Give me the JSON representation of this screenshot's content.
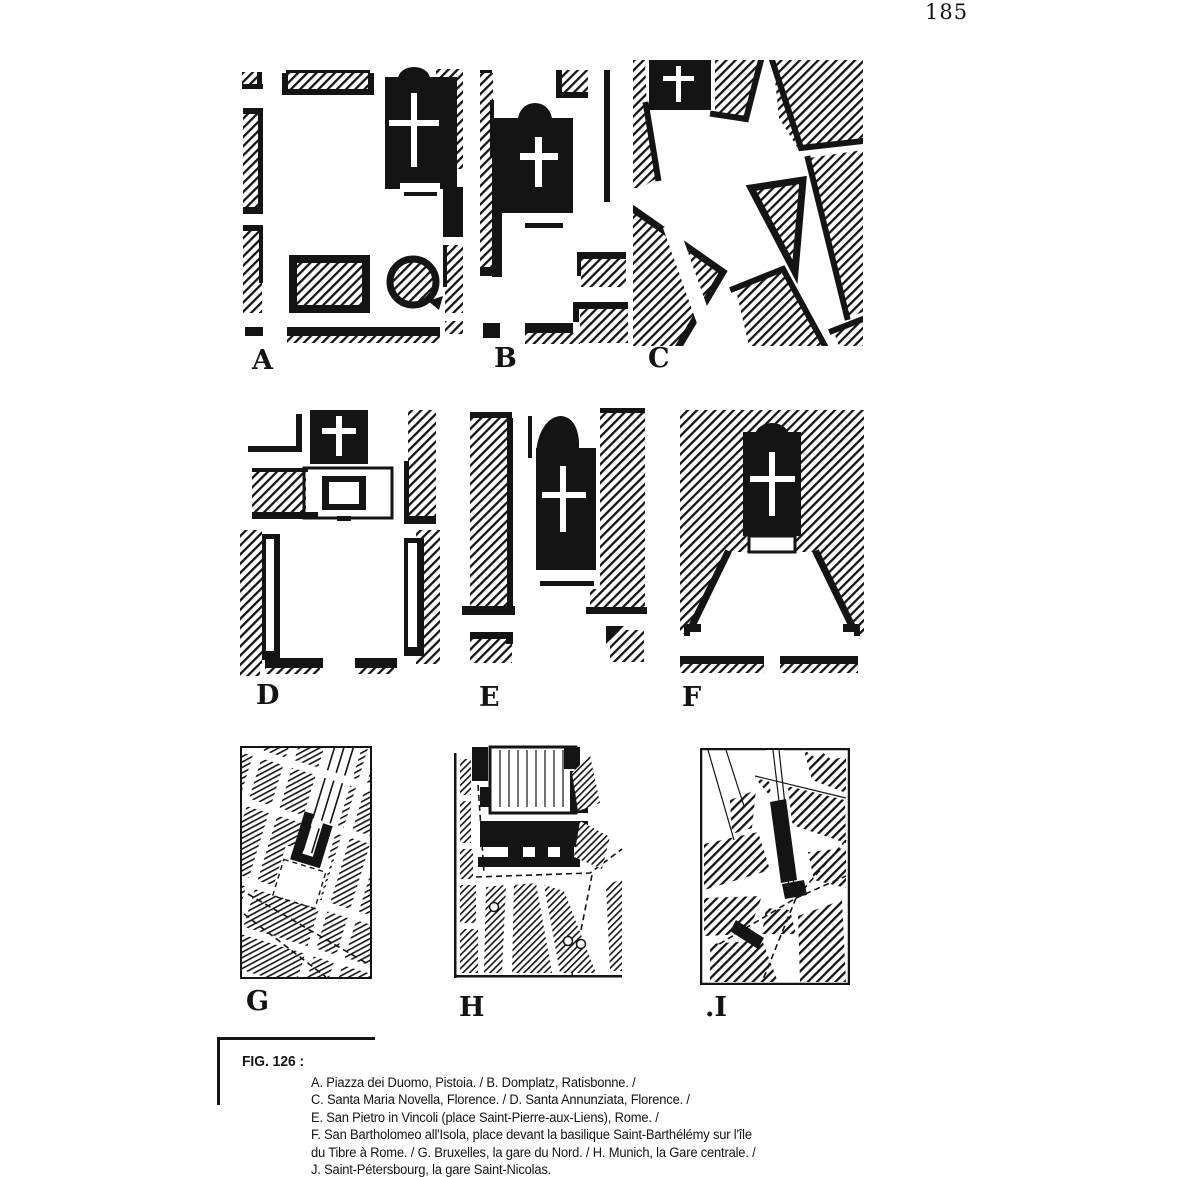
{
  "page": {
    "number": "185"
  },
  "figure": {
    "label": "FIG. 126 :",
    "caption_lines": [
      "A. Piazza dei Duomo, Pistoia. / B. Domplatz, Ratisbonne. /",
      "C. Santa Maria Novella, Florence. / D. Santa Annunziata, Florence. /",
      "E. San Pietro in Vincoli (place Saint-Pierre-aux-Liens), Rome. /",
      "F. San Bartholomeo all'Isola, place devant la basilique Saint-Barthélémy sur l'île",
      "du Tibre à Rome. / G. Bruxelles, la gare du Nord. / H. Munich, la Gare centrale. /",
      "J. Saint-Pétersbourg, la gare Saint-Nicolas."
    ],
    "panels": [
      {
        "label": "A"
      },
      {
        "label": "B"
      },
      {
        "label": "C"
      },
      {
        "label": "D"
      },
      {
        "label": "E"
      },
      {
        "label": "F"
      },
      {
        "label": "G"
      },
      {
        "label": "H"
      },
      {
        "label": ".I"
      }
    ],
    "colors": {
      "ink": "#141414",
      "paper": "#ffffff"
    }
  }
}
